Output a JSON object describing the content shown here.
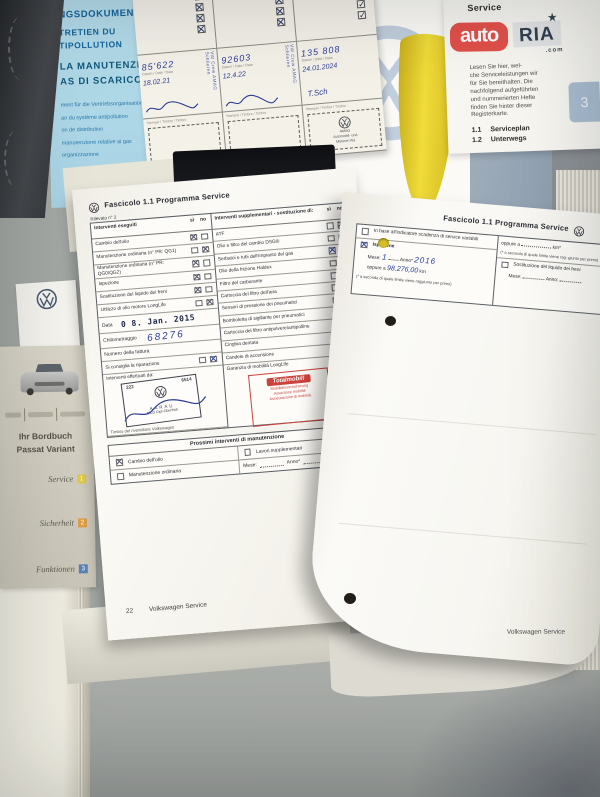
{
  "watermark": {
    "auto": "auto",
    "ria": "RIA",
    "com": ".com",
    "red": "#e25049",
    "navy": "#31404f"
  },
  "blue_document": {
    "bold_lines": [
      "NGSDOKUMENT",
      "TRETIEN DU",
      "TIPOLLUTION",
      "LA MANUTENZIONE",
      "AS DI SCARICO"
    ],
    "small_lines": [
      "ment für die Vertriebsorganisation",
      "an du système antipollution",
      "on de distribution",
      "manutenzione relative ai gas",
      "organizzazione"
    ]
  },
  "stamp_card": {
    "datum_label": "Datum / Date / Data",
    "stamp_label": "Stempel / Timbre / Timbro",
    "columns": [
      {
        "mark": "✕",
        "km": "85'622",
        "date": "18.02.21",
        "stamp_note": "VW Crew AMAG Schlieren"
      },
      {
        "mark": "✕",
        "km": "92603",
        "date": "12.4.22",
        "stamp_note": "VW Crew AMAG Schlieren"
      },
      {
        "mark": "✓",
        "km": "135 808",
        "date": "24.01.2024",
        "signature": "T.Sch"
      }
    ],
    "amag_stamp": [
      "AMAG",
      "Automobil- und",
      "Motoren AG"
    ]
  },
  "service_index": {
    "title": "Service",
    "paragraph": [
      "Lesen Sie hier, wel-",
      "che Serviceleistungen wir",
      "für Sie bereithalten. Die",
      "nachfolgend aufgeführten",
      "und nummerierten Hefte",
      "finden Sie hinter dieser",
      "Registerkarte."
    ],
    "items": [
      {
        "num": "1.1",
        "label": "Serviceplan"
      },
      {
        "num": "1.2",
        "label": "Unterwegs"
      }
    ],
    "tab_number": "3"
  },
  "bordbuch": {
    "title1": "Ihr Bordbuch",
    "title2": "Passat Variant",
    "items": [
      {
        "label": "Service",
        "num": "1",
        "color": "#e0cc48"
      },
      {
        "label": "Sicherheit",
        "num": "2",
        "color": "#dc9f49"
      },
      {
        "label": "Funktionen",
        "num": "3",
        "color": "#5b80b4"
      }
    ]
  },
  "left_page": {
    "header": "Fascicolo 1.1  Programma Service",
    "sub": "Rilevato n° 2",
    "si": "sì",
    "no": "no",
    "executed": {
      "header": "Interventi eseguiti",
      "rows": [
        {
          "label": "Cambio dell'olio",
          "si": true
        },
        {
          "label": "Manutenzione ordinaria (n° PR: QG1)",
          "no": true
        },
        {
          "label": "Manutenzione ordinaria (n° PR: QG0/QG2)",
          "si": true
        },
        {
          "label": "Ispezione",
          "si": true
        },
        {
          "label": "Sostituzione del liquido dei freni",
          "si": true
        },
        {
          "label": "Utilizzo di olio motore LongLife",
          "no": true
        }
      ]
    },
    "supplementary": {
      "header": "Interventi supplementari - sostituzione di:",
      "rows": [
        {
          "label": "ATF",
          "no": true
        },
        {
          "label": "Olio e filtro del cambio DSG®",
          "no": true
        },
        {
          "label": "Serbatoi e tubi dell'impianto del gas",
          "si": true,
          "ink": "pen"
        },
        {
          "label": "Olio della frizione Haldex",
          "no": true
        },
        {
          "label": "Filtro del carburante",
          "no": true
        },
        {
          "label": "Cartuccia del filtro dell'aria",
          "no": true
        },
        {
          "label": "Sensori di pressione dei pneumatici",
          "no": true
        },
        {
          "label": "Bomboletta di sigillante per pneumatici",
          "no": true
        },
        {
          "label": "Cartuccia del filtro antipolvere/antipolline",
          "si": true
        },
        {
          "label": "Cinghia dentata",
          "no": true
        },
        {
          "label": "Candele di accensione",
          "si": true
        }
      ]
    },
    "fields": {
      "data_label": "Data",
      "data_value": "0 8. Jan. 2015",
      "km_label": "Chilometraggio",
      "km_value": "68276",
      "invoice_label": "Numero della fattura",
      "repair_label": "Si consiglia la riparazione"
    },
    "dealer": {
      "label": "Interventi effettuati da:",
      "num_left": "222",
      "num_right": "6514",
      "name": "AARAU",
      "city": "5023 Gipf-Oberfrick",
      "caption": "Timbro del rivenditore Volkswagen"
    },
    "warranty": {
      "label": "Garanzia di mobilità LongLife",
      "badge": "Totalmobil!",
      "lines": [
        "Mobilitätsversicherung",
        "Assurance mobilité",
        "Assicurazione di mobilità"
      ]
    },
    "next_section": {
      "title": "Prossimi interventi di manutenzione",
      "opt_oil": "Cambio dell'olio",
      "opt_maint": "Manutenzione ordinaria",
      "opt_extra": "Lavori supplementari",
      "mese_label": "Mese:",
      "anno_label": "Anno*"
    },
    "page_number": "22",
    "footer": "Volkswagen Service"
  },
  "right_page": {
    "header": "Fascicolo 1.1  Programma Service",
    "box_left": {
      "opt_variable": "In base all'indicatore scadenza di service variabili",
      "opt_inspection": "Ispezione",
      "mese_label": "Mese:",
      "mese_value": "1",
      "anno_label": "Anno*",
      "anno_value": "2016",
      "oppure_label": "oppure a",
      "km_value": "98.276,00",
      "km_unit": "km",
      "note": "(* a seconda di quale limite viene raggiunto per primo)"
    },
    "box_right": {
      "oppure_label": "oppure a",
      "km_unit": "km*",
      "note": "(* a seconda di quale limite viene rag- giunto per primo)",
      "opt_brake": "Sostituzione del liquido dei freni",
      "mese_label": "Mese:",
      "anno_label": "Anno:"
    },
    "footer": "Volkswagen Service"
  }
}
